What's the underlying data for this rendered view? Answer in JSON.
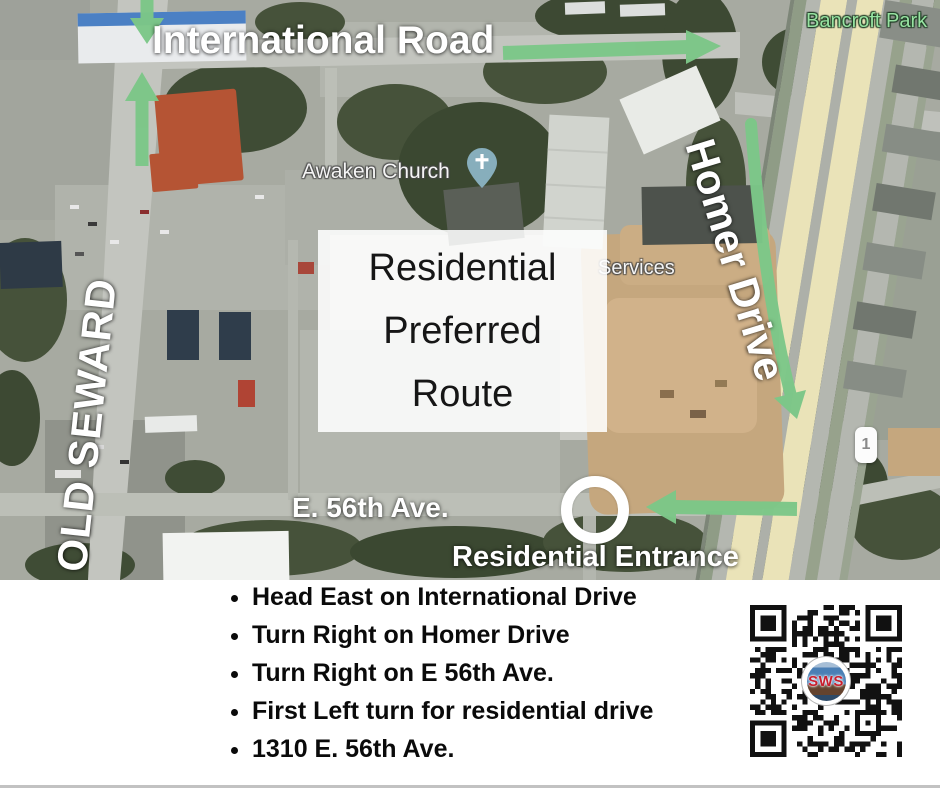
{
  "map": {
    "base_labels": {
      "bancroft_park": "Bancroft Park",
      "awaken_church": "Awaken Church",
      "services_partial": "Services",
      "route_shield": "1"
    },
    "annotations": {
      "international_road": "International Road",
      "old_seward": "OLD SEWARD",
      "homer_drive": "Homer Drive",
      "e_56th_ave": "E. 56th Ave.",
      "residential_entrance": "Residential Entrance",
      "route_box_line1": "Residential",
      "route_box_line2": "Preferred",
      "route_box_line3": "Route"
    },
    "colors": {
      "arrow_green": "#7cc788",
      "park_label_green": "#97e3a1",
      "highway_yellow": "#eae3b8"
    }
  },
  "directions": [
    "Head East on International Drive",
    "Turn Right on Homer Drive",
    "Turn Right on E 56th Ave.",
    "First Left turn for residential drive",
    "1310 E. 56th Ave."
  ],
  "qr": {
    "center_logo_text": "SWS"
  }
}
